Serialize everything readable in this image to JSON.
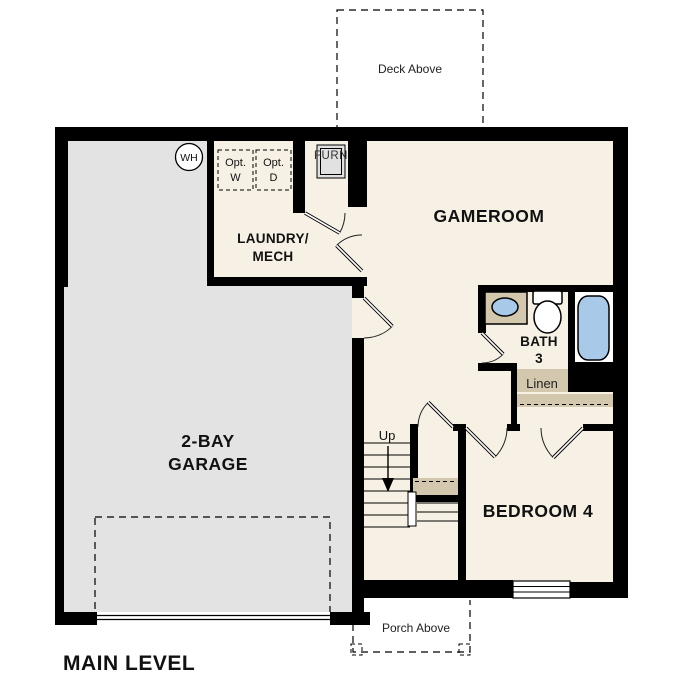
{
  "plan": {
    "title": "MAIN LEVEL",
    "rooms": {
      "garage": {
        "line1": "2-BAY",
        "line2": "GARAGE"
      },
      "gameroom": {
        "label": "GAMEROOM"
      },
      "laundry": {
        "line1": "LAUNDRY/",
        "line2": "MECH"
      },
      "bedroom4": {
        "label": "BEDROOM 4"
      },
      "bath3": {
        "line1": "BATH",
        "line2": "3"
      },
      "linen": {
        "label": "Linen"
      }
    },
    "outdoor": {
      "deck": {
        "label": "Deck Above"
      },
      "porch": {
        "label": "Porch Above"
      }
    },
    "stairs": {
      "up_label": "Up"
    },
    "fixtures": {
      "water_heater": {
        "label": "WH"
      },
      "opt_washer": {
        "line1": "Opt.",
        "line2": "W"
      },
      "opt_dryer": {
        "line1": "Opt.",
        "line2": "D"
      },
      "furnace": {
        "label": "FURN"
      }
    },
    "colors": {
      "wall": "#000000",
      "floor": "#f7f0e4",
      "garage_floor": "#e3e3e3",
      "counter_tan": "#d3c7ae",
      "fixture_blue": "#a9c9e9",
      "appliance_gray": "#e1e1e1",
      "tub_room_white": "#ffffff"
    }
  }
}
